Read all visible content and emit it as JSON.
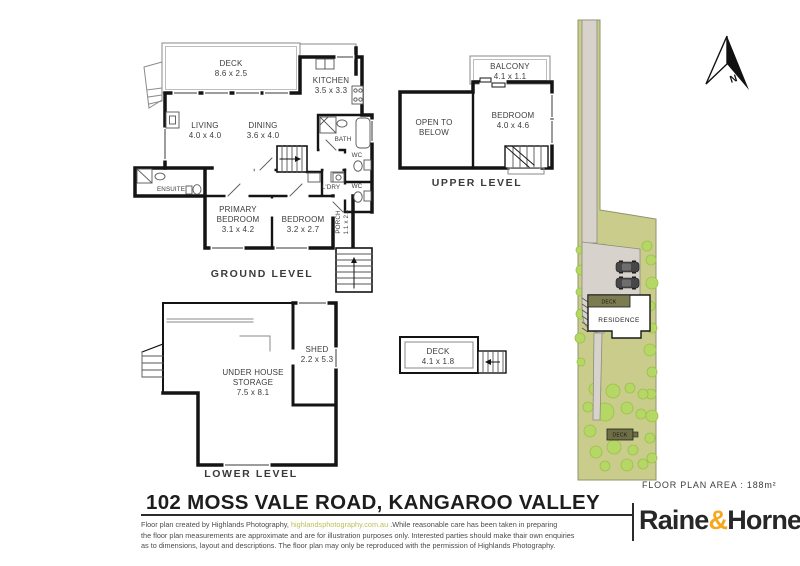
{
  "ground_level": {
    "label": "GROUND LEVEL",
    "deck": {
      "name": "DECK",
      "dims": "8.6 x 2.5"
    },
    "kitchen": {
      "name": "KITCHEN",
      "dims": "3.5 x 3.3"
    },
    "living": {
      "name": "LIVING",
      "dims": "4.0 x 4.0"
    },
    "dining": {
      "name": "DINING",
      "dims": "3.6 x 4.0"
    },
    "bath": {
      "name": "BATH"
    },
    "ensuite": {
      "name": "ENSUITE"
    },
    "wc_upper": {
      "name": "WC"
    },
    "wc_lower": {
      "name": "WC"
    },
    "laundry": {
      "name": "L'DRY"
    },
    "primary_bedroom": {
      "line1": "PRIMARY",
      "line2": "BEDROOM",
      "dims": "3.1 x 4.2"
    },
    "bedroom": {
      "name": "BEDROOM",
      "dims": "3.2 x 2.7"
    },
    "porch": {
      "name": "PORCH",
      "dims": "1.1 x 2.2"
    }
  },
  "upper_level": {
    "label": "UPPER LEVEL",
    "balcony": {
      "name": "BALCONY",
      "dims": "4.1 x 1.1"
    },
    "bedroom": {
      "name": "BEDROOM",
      "dims": "4.0 x 4.6"
    },
    "open_to_below": {
      "line1": "OPEN TO",
      "line2": "BELOW"
    }
  },
  "lower_level": {
    "label": "LOWER LEVEL",
    "shed": {
      "name": "SHED",
      "dims": "2.2 x 5.3"
    },
    "storage": {
      "line1": "UNDER HOUSE",
      "line2": "STORAGE",
      "dims": "7.5 x 8.1"
    }
  },
  "detached_deck": {
    "name": "DECK",
    "dims": "4.1 x 1.8"
  },
  "site_plan": {
    "residence_label": "RESIDENCE",
    "upper_deck_label": "DECK",
    "lower_deck_label": "DECK",
    "north_label": "N"
  },
  "footer": {
    "area_text": "FLOOR PLAN AREA  :  188m²",
    "title": "102 MOSS VALE ROAD, KANGAROO VALLEY",
    "disclaimer": {
      "line1_pre": "Floor plan created by Highlands Photography, ",
      "link": "highlandsphotography.com.au",
      "line1_post": " .While reasonable care has been taken in preparing",
      "line2": "the floor plan measurements are approximate and are for illustration purposes only. Interested parties should make thair own enquiries",
      "line3": "as to dimensions, layout and descriptions. The floor plan may only be reproduced with the permission of Highlands Photography."
    },
    "brand": {
      "word1": "Raine",
      "amp": "&",
      "word2": "Horne",
      "dot": "."
    }
  },
  "colors": {
    "wall_black": "#141414",
    "brand_orange": "#f5a81e",
    "link_olive": "#bcbf55",
    "site_green": "#c9cc8b",
    "tree_green": "#b5d765",
    "paving_grey": "#d7d3cc",
    "deck_olive": "#7c7c50"
  }
}
